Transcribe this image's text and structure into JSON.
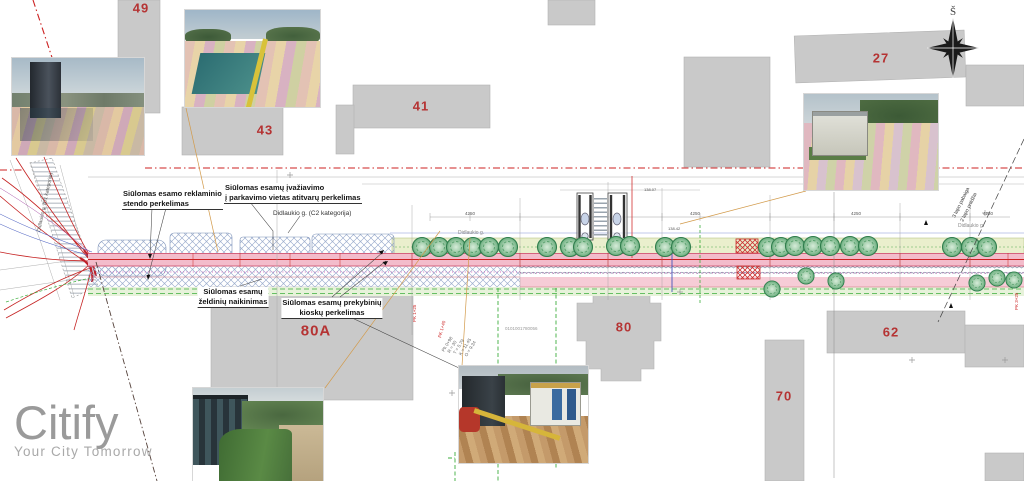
{
  "logo": {
    "name": "Citify",
    "tagline": "Your City Tomorrow"
  },
  "compass": {
    "north_label": "Š"
  },
  "building_labels": {
    "b49": "49",
    "b43": "43",
    "b41": "41",
    "b27": "27",
    "b80a": "80A",
    "b80": "80",
    "b62": "62",
    "b70": "70"
  },
  "annotations": {
    "reklaminio_1": "Siūlomas esamo reklaminio",
    "reklaminio_2": "stendo perkelimas",
    "ivaziavimo_1": "Siūlomas esamų įvažiavimo",
    "ivaziavimo_2": "į parkavimo vietas atitvarų perkelimas",
    "didlaukio_c2": "Didlaukio g. (C2 kategorija)",
    "zeldiniu_1": "Siūlomas esamų",
    "zeldiniu_2": "želdinių naikinimas",
    "kiosku_1": "Siūlomas esamų prekybinių",
    "kiosku_2": "kioskų perkelimas"
  },
  "plan_texts": {
    "street_name_1": "Didlaukio g.",
    "street_name_2": "Didlaukio g.",
    "side_street": "Didlaukio g. (D1 kategorija)",
    "sheet_break_1": "3 lapo pabaiga",
    "sheet_break_2": "2 lapo pradžia",
    "station_1": "PK 1+25",
    "station_2": "PK 1+40",
    "station_3": "PK 3+25",
    "dim_1": "4250",
    "dim_2": "4250",
    "dim_3": "4250",
    "dim_4": "4250",
    "level_1": "138.42",
    "level_2": "138.07",
    "curve_1": "Pk 0+98",
    "curve_2": "R = 30",
    "curve_3": "T = 5.79",
    "curve_4": "K = 11.45",
    "curve_5": "O = 9.34",
    "parcel_ref": "0101001780056"
  },
  "colors": {
    "accent_red": "#b53333",
    "boundary_red": "#cc2222",
    "road_pink": "#f3bccb",
    "green_band": "#eaefcd",
    "tree_green": "#2f7d4c",
    "building_gray": "#c9c9c9",
    "logo_gray": "#9a9a9a"
  }
}
